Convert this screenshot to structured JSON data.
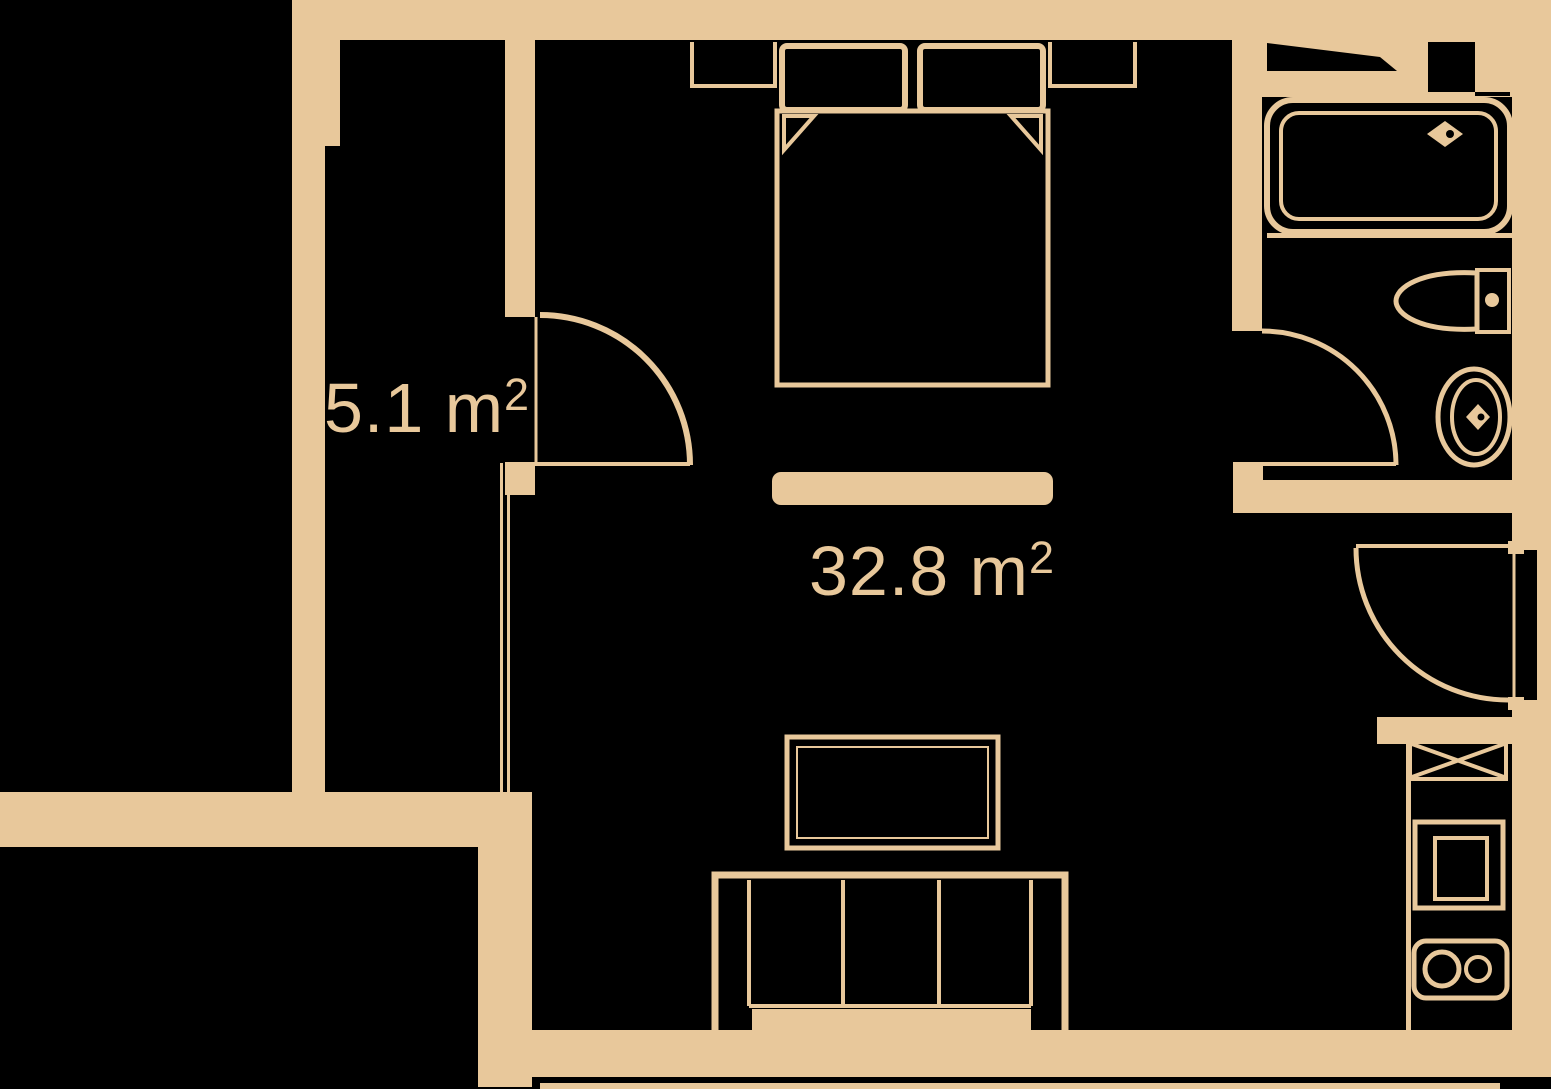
{
  "plan_title": "apartment-floor-plan",
  "colors": {
    "background": "#000000",
    "plan": "#e8c89b"
  },
  "rooms": [
    {
      "id": "hallway",
      "area_value": "5.1",
      "area_unit": " m",
      "area_sup": "2"
    },
    {
      "id": "living-room",
      "area_value": "32.8",
      "area_unit": " m",
      "area_sup": "2"
    }
  ],
  "fixtures": [
    "double-bed",
    "pillow-left",
    "pillow-right",
    "nightstand-left",
    "nightstand-right",
    "bed-foot-bench",
    "tv-stand",
    "sofa",
    "hallway-door",
    "bathroom-door",
    "entrance-door",
    "bathtub",
    "bath-faucet",
    "toilet",
    "washbasin",
    "basin-faucet",
    "washing-machine",
    "oven",
    "cooktop",
    "wardrobe-niche"
  ]
}
